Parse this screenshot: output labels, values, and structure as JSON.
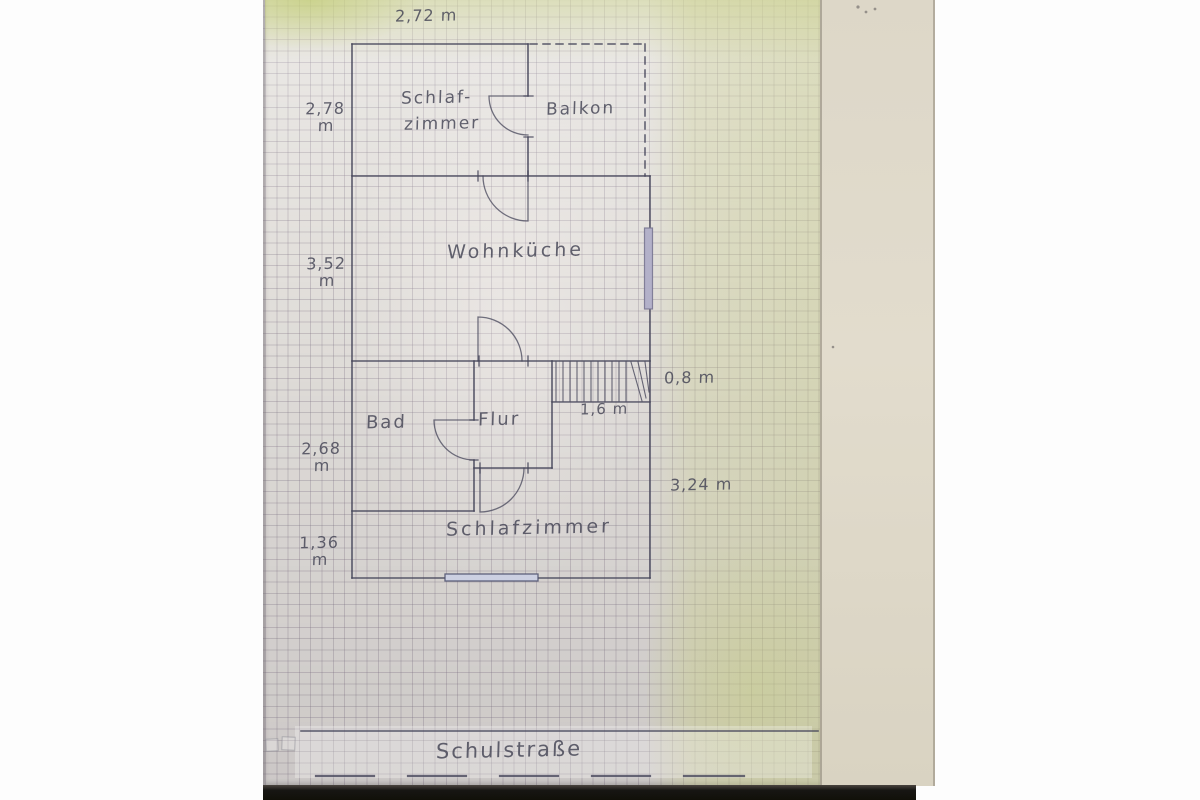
{
  "plan": {
    "rooms": {
      "bedroom_top_line1": "Schlaf-",
      "bedroom_top_line2": "zimmer",
      "balcony": "Balkon",
      "kitchen_living": "Wohnküche",
      "bath": "Bad",
      "hallway": "Flur",
      "bedroom_bottom": "Schlafzimmer"
    },
    "dimensions": {
      "top_width": "2,72 m",
      "left_top": {
        "value": "2,78",
        "unit": "m"
      },
      "left_mid": {
        "value": "3,52",
        "unit": "m"
      },
      "left_lower": {
        "value": "2,68",
        "unit": "m"
      },
      "left_bottom": {
        "value": "1,36",
        "unit": "m"
      },
      "stairs_width": "1,6 m",
      "stairs_depth": "0,8 m",
      "right_height": "3,24 m"
    },
    "street": {
      "name": "Schulstraße"
    }
  },
  "colors": {
    "ink": "#46465a",
    "handwriting": "#474757",
    "window_blue_fill": "#b3b1c9",
    "window_blue_stroke": "#76748f",
    "graph_paper": "#e2dfdb",
    "paper_tint_green": "#c8d080",
    "beige_paper": "#e0dacb",
    "photo_black": "#171613",
    "background_white": "#fdfdfd"
  }
}
